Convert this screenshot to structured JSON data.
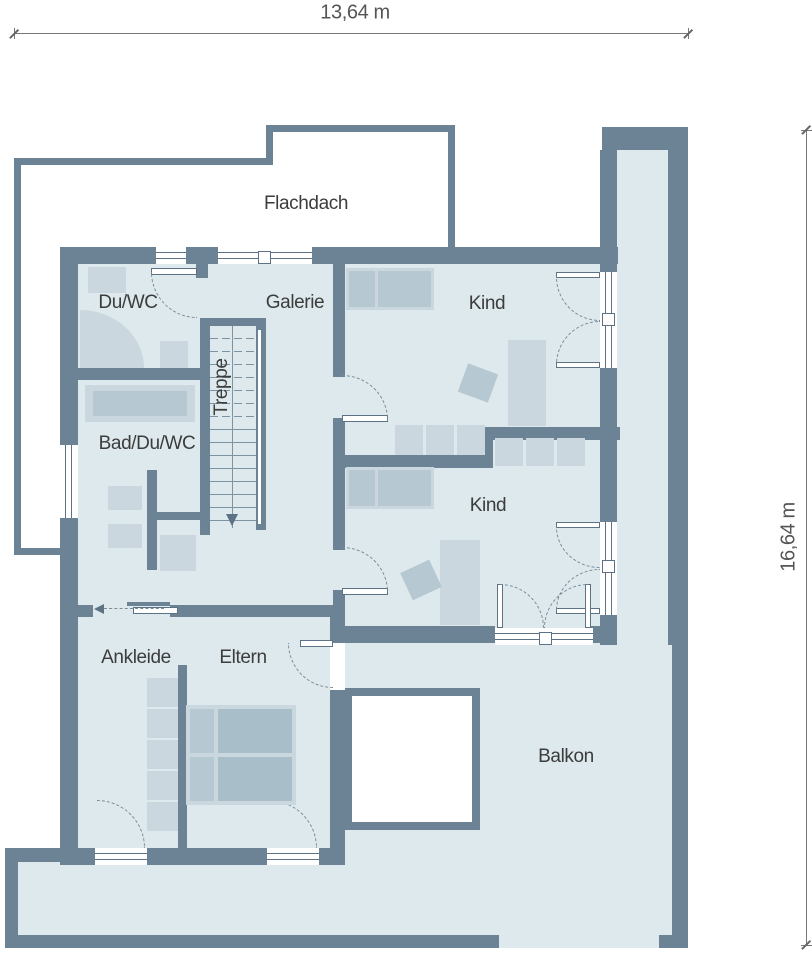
{
  "palette": {
    "wall": "#6b8395",
    "floor": "#dee9ed",
    "furniture_light": "#cbd7de",
    "furniture_mid": "#b6c8d2",
    "furniture_dark": "#a8bfca",
    "outline": "#5d7385",
    "text": "#3c3c3c",
    "dimension": "#555555"
  },
  "dimensions": {
    "width_label": "13,64 m",
    "height_label": "16,64 m"
  },
  "rooms": {
    "flachdach": {
      "label": "Flachdach"
    },
    "duwc": {
      "label": "Du/WC"
    },
    "galerie": {
      "label": "Galerie"
    },
    "kind1": {
      "label": "Kind"
    },
    "badduwc": {
      "label": "Bad/Du/WC"
    },
    "treppe": {
      "label": "Treppe"
    },
    "kind2": {
      "label": "Kind"
    },
    "ankleide": {
      "label": "Ankleide"
    },
    "eltern": {
      "label": "Eltern"
    },
    "balkon": {
      "label": "Balkon"
    }
  }
}
